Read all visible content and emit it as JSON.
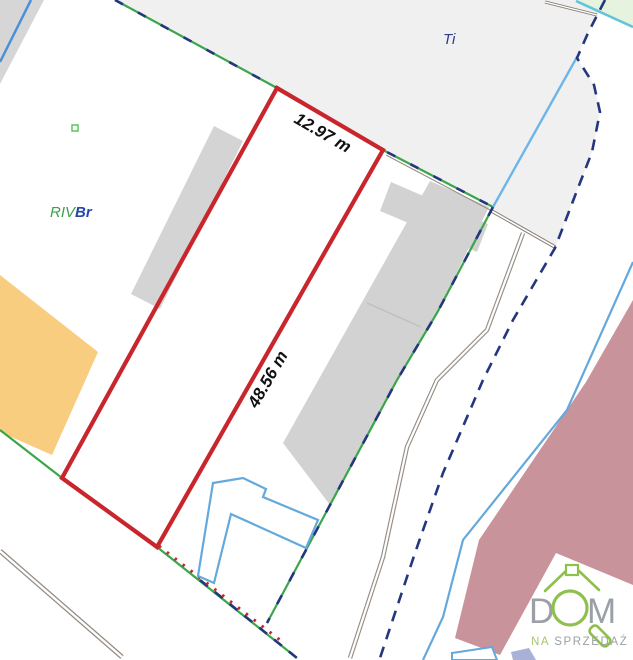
{
  "map": {
    "parcel": {
      "width_label": "12.97 m",
      "length_label": "48.56 m",
      "outline_color": "#c8262c"
    },
    "labels": {
      "land_use": "Ti",
      "soil_class_part1": "RIV",
      "soil_class_part2": "Br"
    },
    "colors": {
      "parcel_red": "#c8262c",
      "boundary_green": "#3aa64a",
      "boundary_navy": "#24367e",
      "building_fill": "#d2d2d2",
      "road_area_fill": "#f0f0f1",
      "orange_parcel_fill": "#f8cd80",
      "mauve_parcel_fill": "#c9939b",
      "building_outline_blue": "#64a8dc",
      "utility_cyan": "#5fc4dc",
      "road_line_gray": "#968e86"
    }
  },
  "watermark": {
    "brand_prefix": "D",
    "brand_suffix": "M",
    "tagline_part1": "NA",
    "tagline_part2": "SPRZEDAŻ",
    "brand_color": "#9aa0a6",
    "accent_green": "#8fbf4d"
  }
}
